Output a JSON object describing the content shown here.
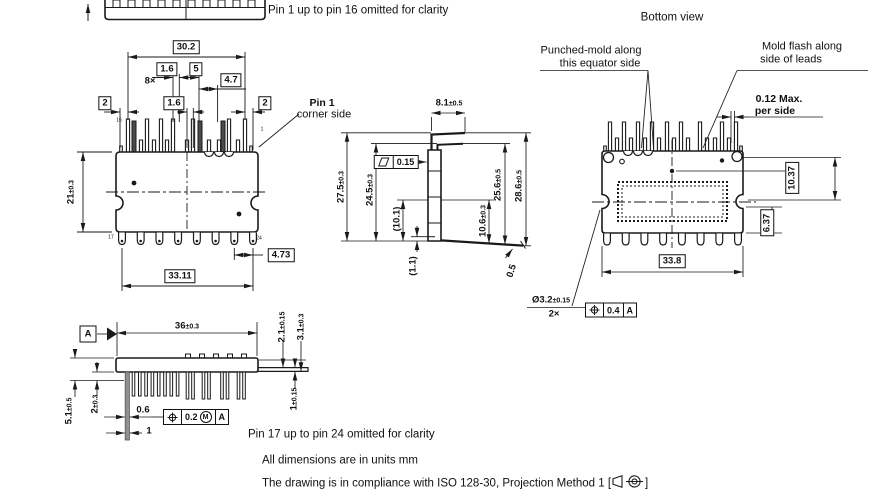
{
  "notes": {
    "pin1_16": "Pin 1 up to pin 16 omitted for clarity",
    "pin17_24": "Pin 17 up to pin 24 omitted for clarity",
    "units": "All dimensions are in units mm",
    "compliance_pre": "The drawing is in compliance with ISO 128-30, Projection Method 1 [",
    "compliance_post": "]"
  },
  "front": {
    "dim_30_2": "30.2",
    "dim_1_6_top": "1.6",
    "dim_5": "5",
    "count_8x": "8×",
    "dim_4_7": "4.7",
    "dim_1_6_mid": "1.6",
    "dim_2_left": "2",
    "dim_2_right": "2",
    "dim_21": {
      "v": "21",
      "t": "±0.3"
    },
    "dim_33_11": "33.11",
    "dim_4_73": "4.73",
    "callout_pin1_line1": "Pin 1",
    "callout_pin1_line2": "corner side",
    "pin16": "16",
    "pin1": "1",
    "pin17": "17",
    "pin24": "24"
  },
  "side": {
    "dim_8_1": {
      "v": "8.1",
      "t": "±0.5"
    },
    "dim_27_5": {
      "v": "27.5",
      "t": "±0.3"
    },
    "dim_24_5": {
      "v": "24.5",
      "t": "±0.3"
    },
    "dim_10_1": "(10.1)",
    "dim_1_1": "(1.1)",
    "dim_10_6": {
      "v": "10.6",
      "t": "±0.3"
    },
    "dim_25_6": {
      "v": "25.6",
      "t": "±0.5"
    },
    "dim_28_6": {
      "v": "28.6",
      "t": "±0.5"
    },
    "dim_0_5": "0.5",
    "flatness": {
      "symbol": "flatness-parallelogram",
      "value": "0.15"
    }
  },
  "bottom_view": {
    "title": "Bottom view",
    "callout_punched_1": "Punched-mold along",
    "callout_punched_2": "this equator side",
    "callout_flash_1": "Mold flash along",
    "callout_flash_2": "side of leads",
    "dim_0_12_1": "0.12 Max.",
    "dim_0_12_2": "per side",
    "dim_10_37": "10.37",
    "dim_6_37": "6.37",
    "dim_33_8": "33.8",
    "hole": {
      "v": "Ø3.2",
      "t": "±0.15",
      "count": "2×"
    },
    "fcf": {
      "symbol": "position",
      "value": "0.4",
      "datum": "A"
    }
  },
  "top_view": {
    "datum": "A",
    "dim_36": {
      "v": "36",
      "t": "±0.3"
    },
    "dim_2_1": {
      "v": "2.1",
      "t": "±0.15"
    },
    "dim_3_1": {
      "v": "3.1",
      "t": "±0.3"
    },
    "dim_5_1": {
      "v": "5.1",
      "t": "±0.5"
    },
    "dim_2": {
      "v": "2",
      "t": "±0.3"
    },
    "dim_0_6": "0.6",
    "dim_1": "1",
    "dim_1_tol": {
      "v": "1",
      "t": "±0.15"
    },
    "fcf": {
      "symbol": "position",
      "value": "0.2",
      "modifier": "M",
      "datum": "A"
    }
  },
  "colors": {
    "line": "#1a1a1a",
    "lead_fill": "#919191",
    "dark_pin": "#4a4a4a"
  }
}
